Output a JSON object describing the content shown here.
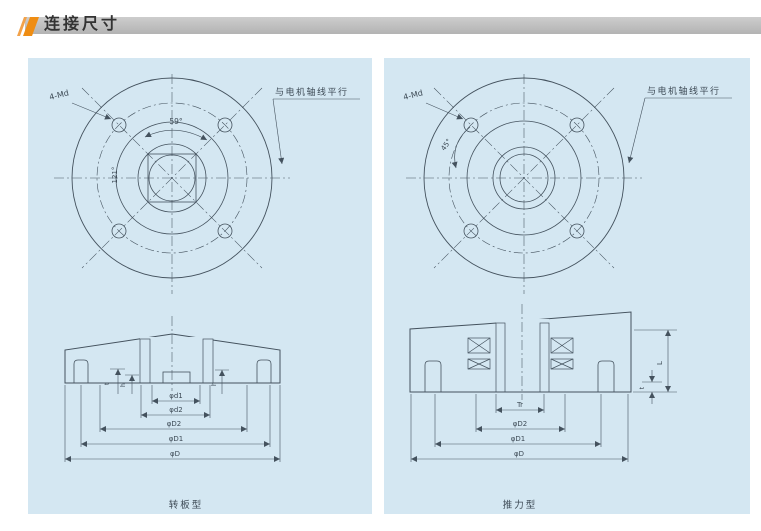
{
  "header": {
    "title": "连接尺寸"
  },
  "left_panel": {
    "caption": "转板型",
    "top_view": {
      "bolt_label": "4-Md",
      "angle_top": "59°",
      "angle_left": "121°",
      "axis_note": "与电机轴线平行"
    },
    "section": {
      "dia_dims": [
        "φd1",
        "φd2",
        "φD2",
        "φD1",
        "φD"
      ],
      "small_dims": [
        "t",
        "h",
        "h"
      ]
    }
  },
  "right_panel": {
    "caption": "推力型",
    "top_view": {
      "bolt_label": "4-Md",
      "angle_left": "45°",
      "axis_note": "与电机轴线平行"
    },
    "section": {
      "dia_dims": [
        "Tr",
        "φD2",
        "φD1",
        "φD"
      ],
      "side_dims": [
        "L",
        "t"
      ]
    }
  },
  "colors": {
    "panel_bg": "#d4e7f2",
    "line": "#44525e",
    "header_bar": "#b8b8b8",
    "accent_orange": "#ef8d13"
  }
}
